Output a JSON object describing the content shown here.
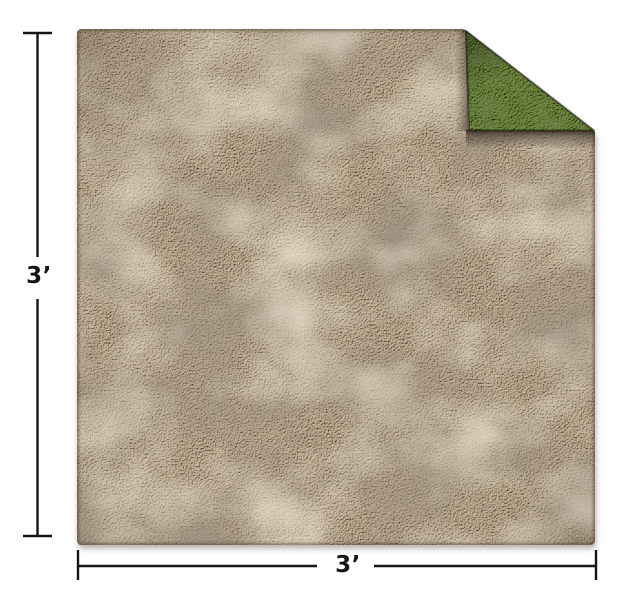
{
  "page": {
    "background_color": "#ffffff"
  },
  "product": {
    "name": "double-sided battle mat",
    "front_texture": "brown dirt",
    "back_texture": "green grass (shown on folded top-right corner)",
    "colors": {
      "dirt_base": "#a4917a",
      "dirt_highlight": "#c9b599",
      "dirt_mottle_dark": "#57483a",
      "dirt_mottle_light": "#d9c7a4",
      "grass_base": "#5f7a38",
      "grass_highlight": "#74913f",
      "grass_mottle_dark": "#293b12",
      "fold_shadow": "#140d06",
      "drop_shadow": "#6b635a"
    }
  },
  "dimensions": {
    "height": {
      "label": "3’"
    },
    "width": {
      "label": "3’"
    },
    "line_color": "#151515"
  }
}
